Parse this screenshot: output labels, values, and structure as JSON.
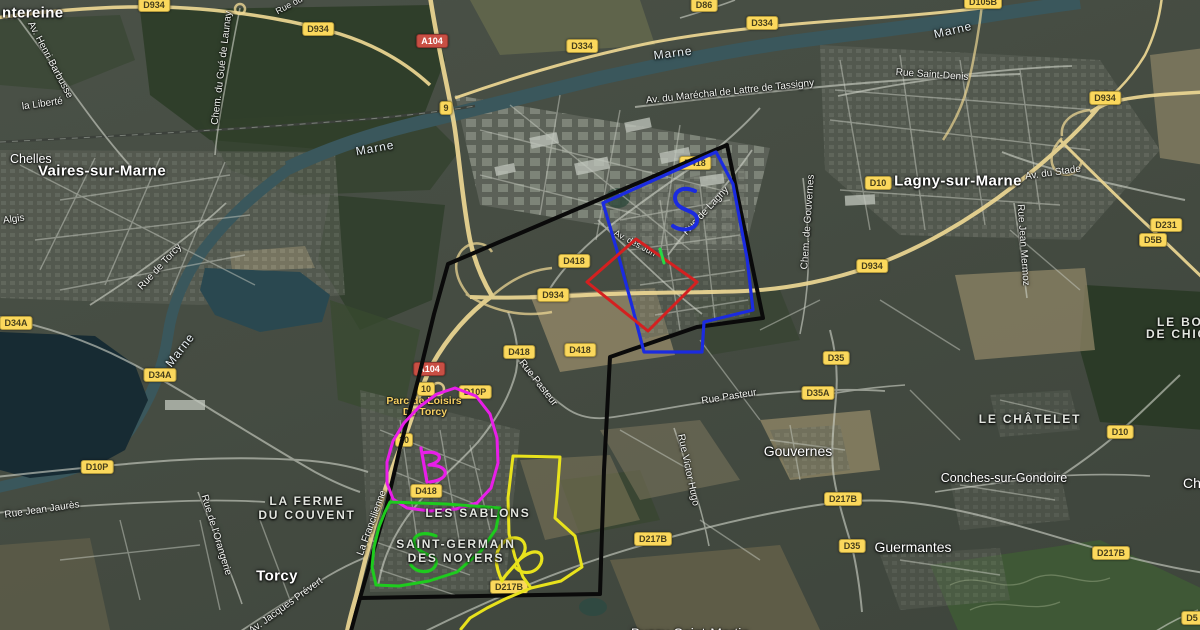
{
  "colors": {
    "boundary_black": "#0a0a0a",
    "boundary_blue": "#1b2be0",
    "boundary_red": "#d42020",
    "boundary_magenta": "#e81ee8",
    "boundary_green": "#1ecb1e",
    "boundary_yellow": "#e8e21c",
    "scribble_tick_green": "#27d845",
    "badge_yellow": "#fbd85c",
    "badge_red": "#c94f44",
    "river": "#3a575c"
  },
  "badges": [
    {
      "label": "D934",
      "x": 154,
      "y": 5,
      "kind": "route"
    },
    {
      "label": "D934",
      "x": 318,
      "y": 29,
      "kind": "route"
    },
    {
      "label": "A104",
      "x": 432,
      "y": 41,
      "kind": "motorway"
    },
    {
      "label": "9",
      "x": 446,
      "y": 108,
      "kind": "exit"
    },
    {
      "label": "D334",
      "x": 582,
      "y": 46,
      "kind": "route"
    },
    {
      "label": "D86",
      "x": 704,
      "y": 5,
      "kind": "route"
    },
    {
      "label": "D334",
      "x": 762,
      "y": 23,
      "kind": "route"
    },
    {
      "label": "D105B",
      "x": 983,
      "y": 2,
      "kind": "route"
    },
    {
      "label": "D934",
      "x": 1105,
      "y": 98,
      "kind": "route"
    },
    {
      "label": "D10",
      "x": 878,
      "y": 183,
      "kind": "route"
    },
    {
      "label": "D231",
      "x": 1166,
      "y": 225,
      "kind": "route"
    },
    {
      "label": "D5B",
      "x": 1153,
      "y": 240,
      "kind": "route"
    },
    {
      "label": "D418",
      "x": 695,
      "y": 163,
      "kind": "route"
    },
    {
      "label": "D418",
      "x": 574,
      "y": 261,
      "kind": "route"
    },
    {
      "label": "D934",
      "x": 553,
      "y": 295,
      "kind": "route"
    },
    {
      "label": "D934",
      "x": 872,
      "y": 266,
      "kind": "route"
    },
    {
      "label": "D34A",
      "x": 16,
      "y": 323,
      "kind": "route"
    },
    {
      "label": "D34A",
      "x": 160,
      "y": 375,
      "kind": "route"
    },
    {
      "label": "D418",
      "x": 519,
      "y": 352,
      "kind": "route"
    },
    {
      "label": "D418",
      "x": 580,
      "y": 350,
      "kind": "route"
    },
    {
      "label": "D35",
      "x": 836,
      "y": 358,
      "kind": "route"
    },
    {
      "label": "D35A",
      "x": 818,
      "y": 393,
      "kind": "route"
    },
    {
      "label": "A104",
      "x": 429,
      "y": 369,
      "kind": "motorway"
    },
    {
      "label": "10",
      "x": 426,
      "y": 389,
      "kind": "exit"
    },
    {
      "label": "D10P",
      "x": 475,
      "y": 392,
      "kind": "route"
    },
    {
      "label": "10",
      "x": 404,
      "y": 440,
      "kind": "exit"
    },
    {
      "label": "D10P",
      "x": 97,
      "y": 467,
      "kind": "route"
    },
    {
      "label": "D418",
      "x": 426,
      "y": 491,
      "kind": "route"
    },
    {
      "label": "D217B",
      "x": 843,
      "y": 499,
      "kind": "route"
    },
    {
      "label": "D217B",
      "x": 653,
      "y": 539,
      "kind": "route"
    },
    {
      "label": "D35",
      "x": 852,
      "y": 546,
      "kind": "route"
    },
    {
      "label": "D217B",
      "x": 1111,
      "y": 553,
      "kind": "route"
    },
    {
      "label": "D10",
      "x": 1120,
      "y": 432,
      "kind": "route"
    },
    {
      "label": "D217B",
      "x": 509,
      "y": 587,
      "kind": "route"
    },
    {
      "label": "D5",
      "x": 1192,
      "y": 618,
      "kind": "route"
    }
  ],
  "labels": [
    {
      "text": "Av. Henri Barbusse",
      "x": 50,
      "y": 60,
      "rot": 62,
      "cls": "street",
      "layer": "under",
      "anchor": "center"
    },
    {
      "text": "la Liberté",
      "x": 22,
      "y": 107,
      "rot": -8,
      "cls": "street",
      "layer": "under",
      "anchor": "left"
    },
    {
      "text": "Chem. du Gué de Launay",
      "x": 222,
      "y": 68,
      "rot": -83,
      "cls": "street",
      "layer": "under",
      "anchor": "center"
    },
    {
      "text": "Rue du",
      "x": 289,
      "y": 5,
      "rot": -28,
      "cls": "street-sm",
      "layer": "under",
      "anchor": "center"
    },
    {
      "text": "Algis",
      "x": 3,
      "y": 221,
      "rot": -8,
      "cls": "street",
      "layer": "under",
      "anchor": "left"
    },
    {
      "text": "Rue de Torcy",
      "x": 160,
      "y": 267,
      "rot": -47,
      "cls": "street",
      "layer": "under",
      "anchor": "center"
    },
    {
      "text": "Marne",
      "x": 375,
      "y": 148,
      "rot": -10,
      "cls": "river",
      "layer": "under",
      "anchor": "center"
    },
    {
      "text": "Marne",
      "x": 673,
      "y": 53,
      "rot": -7,
      "cls": "river",
      "layer": "under",
      "anchor": "center"
    },
    {
      "text": "Marne",
      "x": 953,
      "y": 30,
      "rot": -13,
      "cls": "river",
      "layer": "under",
      "anchor": "center"
    },
    {
      "text": "Marne",
      "x": 180,
      "y": 350,
      "rot": -52,
      "cls": "river",
      "layer": "under",
      "anchor": "center"
    },
    {
      "text": "Av. du Maréchal de Lattre de Tassigny",
      "x": 730,
      "y": 92,
      "rot": -6,
      "cls": "street",
      "layer": "under",
      "anchor": "center"
    },
    {
      "text": "Rue Saint-Denis",
      "x": 932,
      "y": 75,
      "rot": 4,
      "cls": "street",
      "layer": "under",
      "anchor": "center"
    },
    {
      "text": "Av. du Stade",
      "x": 1053,
      "y": 173,
      "rot": -8,
      "cls": "street",
      "layer": "under",
      "anchor": "center"
    },
    {
      "text": "Rue Jean Mermoz",
      "x": 1023,
      "y": 245,
      "rot": 86,
      "cls": "street",
      "layer": "under",
      "anchor": "center"
    },
    {
      "text": "Rue de Lagny",
      "x": 706,
      "y": 211,
      "rot": -47,
      "cls": "street",
      "layer": "under",
      "anchor": "center"
    },
    {
      "text": "Chem. de Gouvernes",
      "x": 808,
      "y": 222,
      "rot": -86,
      "cls": "street",
      "layer": "under",
      "anchor": "center"
    },
    {
      "text": "Av. des Jun",
      "x": 635,
      "y": 243,
      "rot": 28,
      "cls": "street-sm",
      "layer": "under",
      "anchor": "center"
    },
    {
      "text": "Rue Jean Jaurès",
      "x": 42,
      "y": 510,
      "rot": -8,
      "cls": "street",
      "layer": "under",
      "anchor": "center"
    },
    {
      "text": "Rue de l'Orangerie",
      "x": 216,
      "y": 535,
      "rot": 73,
      "cls": "street",
      "layer": "under",
      "anchor": "center"
    },
    {
      "text": "Av. Jacques Prévert",
      "x": 286,
      "y": 606,
      "rot": -36,
      "cls": "street",
      "layer": "under",
      "anchor": "center"
    },
    {
      "text": "La Francilienne",
      "x": 372,
      "y": 523,
      "rot": -70,
      "cls": "street",
      "layer": "under",
      "anchor": "center"
    },
    {
      "text": "Rue Pasteur",
      "x": 538,
      "y": 383,
      "rot": 52,
      "cls": "street",
      "layer": "under",
      "anchor": "center"
    },
    {
      "text": "Rue Pasteur",
      "x": 729,
      "y": 397,
      "rot": -9,
      "cls": "street",
      "layer": "under",
      "anchor": "center"
    },
    {
      "text": "Rue Victor Hugo",
      "x": 688,
      "y": 470,
      "rot": 78,
      "cls": "street",
      "layer": "under",
      "anchor": "center"
    },
    {
      "text": "Parc de Loisirs",
      "x": 424,
      "y": 401,
      "rot": 0,
      "cls": "poi",
      "layer": "under",
      "anchor": "center"
    },
    {
      "text": "De Torcy",
      "x": 425,
      "y": 412,
      "rot": 0,
      "cls": "poi",
      "layer": "under",
      "anchor": "center"
    },
    {
      "text": "ntereine",
      "x": 2,
      "y": 13,
      "rot": 0,
      "cls": "city-lg",
      "layer": "over",
      "anchor": "left"
    },
    {
      "text": "Chelles",
      "x": 10,
      "y": 159,
      "rot": 0,
      "cls": "city-sm",
      "layer": "over",
      "anchor": "left"
    },
    {
      "text": "Vaires-sur-Marne",
      "x": 102,
      "y": 171,
      "rot": 0,
      "cls": "city-lg",
      "layer": "over",
      "anchor": "center"
    },
    {
      "text": "Lagny-sur-Marne",
      "x": 958,
      "y": 181,
      "rot": 0,
      "cls": "city-lg",
      "layer": "over",
      "anchor": "center"
    },
    {
      "text": "Torcy",
      "x": 277,
      "y": 576,
      "rot": 0,
      "cls": "city-lg",
      "layer": "over",
      "anchor": "center"
    },
    {
      "text": "Gouvernes",
      "x": 798,
      "y": 451,
      "rot": 0,
      "cls": "city-md",
      "layer": "over",
      "anchor": "center"
    },
    {
      "text": "Guermantes",
      "x": 913,
      "y": 547,
      "rot": 0,
      "cls": "city-md",
      "layer": "over",
      "anchor": "center"
    },
    {
      "text": "Conches-sur-Gondoire",
      "x": 1004,
      "y": 478,
      "rot": 0,
      "cls": "city-sm",
      "layer": "over",
      "anchor": "center"
    },
    {
      "text": "Chanteloup",
      "x": 1183,
      "y": 483,
      "rot": 0,
      "cls": "city-md",
      "layer": "over",
      "anchor": "left"
    },
    {
      "text": "LA FERME",
      "x": 307,
      "y": 501,
      "rot": 0,
      "cls": "area",
      "layer": "over",
      "anchor": "center"
    },
    {
      "text": "DU COUVENT",
      "x": 307,
      "y": 515,
      "rot": 0,
      "cls": "area",
      "layer": "over",
      "anchor": "center"
    },
    {
      "text": "LE CHÂTELET",
      "x": 1030,
      "y": 419,
      "rot": 0,
      "cls": "area",
      "layer": "over",
      "anchor": "center"
    },
    {
      "text": "LES SABLONS",
      "x": 478,
      "y": 513,
      "rot": 0,
      "cls": "area",
      "layer": "over",
      "anchor": "center"
    },
    {
      "text": "SAINT-GERMAIN",
      "x": 456,
      "y": 544,
      "rot": 0,
      "cls": "area",
      "layer": "over",
      "anchor": "center"
    },
    {
      "text": "DES NOYERS",
      "x": 456,
      "y": 558,
      "rot": 0,
      "cls": "area",
      "layer": "over",
      "anchor": "center"
    },
    {
      "text": "LE BOIS",
      "x": 1157,
      "y": 322,
      "rot": 0,
      "cls": "area",
      "layer": "over",
      "anchor": "left"
    },
    {
      "text": "DE CHIGNY",
      "x": 1146,
      "y": 334,
      "rot": 0,
      "cls": "area",
      "layer": "over",
      "anchor": "left"
    },
    {
      "text": "Bussy-Saint-Martin",
      "x": 690,
      "y": 633,
      "rot": 0,
      "cls": "city-md",
      "layer": "over",
      "anchor": "center"
    }
  ],
  "overlays": {
    "shapes": [
      {
        "name": "black-boundary",
        "color": "#0a0a0a",
        "width": 4,
        "closed": true,
        "points": [
          [
            360,
            598
          ],
          [
            372,
            556
          ],
          [
            386,
            508
          ],
          [
            400,
            448
          ],
          [
            418,
            380
          ],
          [
            434,
            314
          ],
          [
            448,
            264
          ],
          [
            727,
            145
          ],
          [
            763,
            318
          ],
          [
            697,
            327
          ],
          [
            610,
            357
          ],
          [
            604,
            470
          ],
          [
            600,
            594
          ]
        ]
      },
      {
        "name": "black-boundary-tail",
        "color": "#0a0a0a",
        "width": 4,
        "closed": false,
        "points": [
          [
            360,
            598
          ],
          [
            351,
            631
          ]
        ]
      },
      {
        "name": "blue-boundary",
        "color": "#1b2be0",
        "width": 3.2,
        "closed": true,
        "points": [
          [
            603,
            203
          ],
          [
            716,
            152
          ],
          [
            733,
            184
          ],
          [
            747,
            258
          ],
          [
            753,
            310
          ],
          [
            704,
            322
          ],
          [
            702,
            352
          ],
          [
            644,
            352
          ],
          [
            632,
            306
          ],
          [
            618,
            254
          ]
        ]
      },
      {
        "name": "red-boundary",
        "color": "#d42020",
        "width": 3,
        "closed": true,
        "points": [
          [
            636,
            239
          ],
          [
            697,
            282
          ],
          [
            648,
            331
          ],
          [
            587,
            282
          ]
        ]
      },
      {
        "name": "magenta-boundary",
        "color": "#e81ee8",
        "width": 3,
        "closed": true,
        "points": [
          [
            455,
            388
          ],
          [
            476,
            396
          ],
          [
            490,
            414
          ],
          [
            497,
            438
          ],
          [
            498,
            463
          ],
          [
            491,
            488
          ],
          [
            477,
            503
          ],
          [
            456,
            509
          ],
          [
            430,
            511
          ],
          [
            407,
            508
          ],
          [
            393,
            499
          ],
          [
            387,
            483
          ],
          [
            387,
            462
          ],
          [
            393,
            441
          ],
          [
            404,
            423
          ],
          [
            419,
            407
          ],
          [
            437,
            394
          ]
        ]
      },
      {
        "name": "green-boundary",
        "color": "#1ecb1e",
        "width": 3,
        "closed": true,
        "points": [
          [
            390,
            502
          ],
          [
            446,
            504
          ],
          [
            500,
            508
          ],
          [
            496,
            529
          ],
          [
            481,
            551
          ],
          [
            457,
            572
          ],
          [
            429,
            581
          ],
          [
            399,
            586
          ],
          [
            376,
            585
          ],
          [
            372,
            567
          ],
          [
            374,
            547
          ],
          [
            379,
            527
          ],
          [
            385,
            512
          ]
        ]
      },
      {
        "name": "yellow-boundary",
        "color": "#e8e21c",
        "width": 3,
        "closed": true,
        "points": [
          [
            513,
            456
          ],
          [
            560,
            457
          ],
          [
            557,
            497
          ],
          [
            555,
            518
          ],
          [
            575,
            536
          ],
          [
            582,
            567
          ],
          [
            561,
            581
          ],
          [
            531,
            588
          ],
          [
            523,
            577
          ],
          [
            515,
            557
          ],
          [
            509,
            534
          ],
          [
            508,
            498
          ]
        ]
      },
      {
        "name": "yellow-boundary-tail",
        "color": "#e8e21c",
        "width": 3,
        "closed": false,
        "points": [
          [
            531,
            588
          ],
          [
            505,
            599
          ],
          [
            487,
            608
          ],
          [
            470,
            618
          ],
          [
            461,
            629
          ]
        ]
      }
    ],
    "scribbles": [
      {
        "name": "blue-s-scribble",
        "color": "#1b2be0",
        "width": 4,
        "path": "M695,191 C681,185 672,193 676,202 C680,211 696,210 697,219 C698,229 683,233 673,226"
      },
      {
        "name": "magenta-b-scribble",
        "color": "#e81ee8",
        "width": 3.2,
        "path": "M421,448 L427,482 M422,453 C441,449 446,461 429,465 C449,465 452,479 430,482"
      },
      {
        "name": "green-s-scribble",
        "color": "#1ecb1e",
        "width": 3.2,
        "path": "M436,536 C419,529 408,539 417,548 C426,557 438,555 436,564 C433,574 417,574 411,565"
      },
      {
        "name": "yellow-loop-scribble",
        "color": "#e8e21c",
        "width": 3.2,
        "path": "M502,581 C492,560 496,545 509,539 C523,534 531,547 520,559 C511,570 504,576 502,581 M519,560 C534,547 545,551 541,563 C536,574 523,575 516,568"
      },
      {
        "name": "green-tick-scribble",
        "color": "#27d845",
        "width": 3,
        "path": "M660,249 L664,263"
      }
    ]
  }
}
